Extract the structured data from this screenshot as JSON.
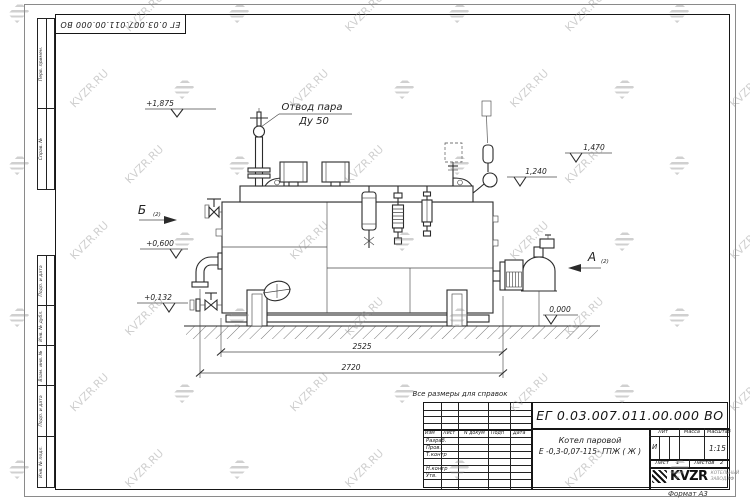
{
  "page": {
    "corner_stamp": "ЕГ 0.03.007.011.00.000  ВО",
    "format_label": "Формат А3",
    "note": "Все размеры для справок"
  },
  "watermark": {
    "text": "KVZR.RU"
  },
  "frame_columns": {
    "top": [
      "Перв. примен.",
      "Справ. №"
    ],
    "bottom": [
      "Подп. и дата",
      "Инв. № дубл.",
      "Взам. инв. №",
      "Подп. и дата",
      "Инв. № подл."
    ]
  },
  "drawing": {
    "steam_outlet_label": "Отвод пара",
    "steam_outlet_size": "Ду 50",
    "view_b": "Б",
    "view_b_index": "(2)",
    "view_a": "А",
    "view_a_index": "(2)",
    "elevations": {
      "steam_valve_top": "+1,875",
      "rear_fitting": "1,470",
      "drum_top": "1,240",
      "mid_left": "+0,600",
      "low_left": "+0,132",
      "ground": "0,000"
    },
    "dimensions": {
      "inner_length": "2525",
      "overall_length": "2720"
    }
  },
  "title_block": {
    "doc_number": "ЕГ 0.03.007.011.00.000  ВО",
    "product_name_line1": "Котел паровой",
    "product_name_line2": "Е -0,3-0,07-115- ГПЖ ( Ж )",
    "revision_header": [
      "Изм",
      "Лист",
      "N докум",
      "Подп",
      "Дата"
    ],
    "signature_rows": [
      "Разраб.",
      "Пров.",
      "Т.контр",
      "Н.контр",
      "Утв."
    ],
    "lit_label": "Лит",
    "lit_value": "И",
    "mass_label": "Масса",
    "scale_label": "Масштаб",
    "scale_value": "1:15",
    "sheet_label": "Лист",
    "sheet_value": "1",
    "sheets_label": "Листов",
    "sheets_value": "2",
    "company_logo_text": "KVZR",
    "company_sub_line1": "КОТЕЛЬНЫЙ",
    "company_sub_line2": "ЗАВОД.РФ"
  }
}
